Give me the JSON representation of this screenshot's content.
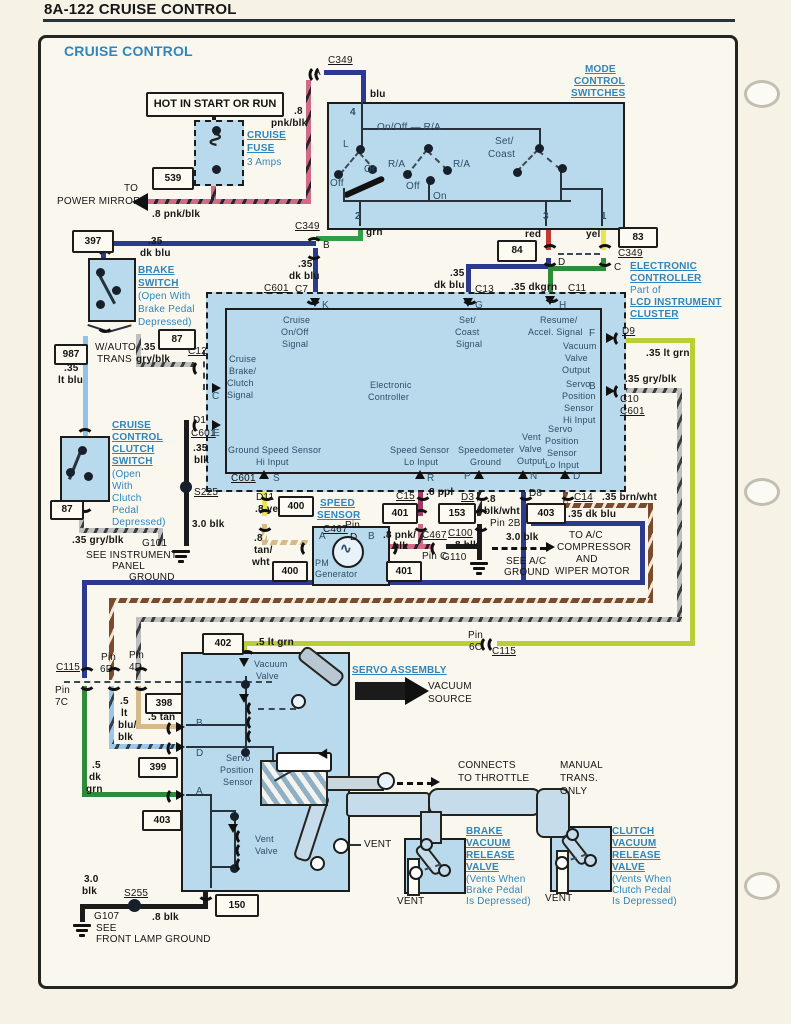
{
  "header": {
    "title": "8A-122 CRUISE CONTROL"
  },
  "diagram_title": "CRUISE CONTROL",
  "colors": {
    "component_fill": "#b9d9ec",
    "heading_blue": "#2f85bb",
    "wire_navy": "#2c3a8e",
    "wire_green": "#2f9e44",
    "wire_red": "#c23b32",
    "wire_yellow": "#e9e44f",
    "wire_lt_blue": "#8fc3e8",
    "wire_lt_green": "#bace38",
    "wire_dk_green": "#2e8b3a",
    "wire_purple": "#a03a62",
    "wire_tan": "#d8ba8a",
    "wire_pink": "#d06a85",
    "wire_black": "#1b1b1b"
  },
  "power": {
    "hot": "HOT IN START OR RUN",
    "fuse_l1": "CRUISE",
    "fuse_l2": "FUSE",
    "fuse_amps": "3 Amps",
    "ref": "539",
    "to": "TO",
    "dest": "POWER MIRRORS",
    "wire": ".8 pnk/blk",
    "wire_v1": ".8",
    "wire_v2": "pnk/blk"
  },
  "c349_top": {
    "label": "C349",
    "pin": "A",
    "wire": "blu"
  },
  "mode": {
    "l1": "MODE",
    "l2": "CONTROL",
    "l3": "SWITCHES",
    "pin4": "4",
    "pin2": "2",
    "pin3": "3",
    "pin1": "1",
    "onoff_ra": "On/Off — R/A",
    "l": "L",
    "off1": "Off",
    "on1": "On",
    "ra1": "R/A",
    "off2": "Off",
    "on2": "On",
    "ra2": "R/A",
    "set": "Set/",
    "coast": "Coast",
    "grn": "grn",
    "red": "red",
    "yel": "yel"
  },
  "conn": {
    "c349b": "C349",
    "pin_b": "B",
    "b_w1": ".35",
    "b_w2": "dk blu",
    "ref84": "84",
    "pin_d": "D",
    "ref83": "83",
    "c349c": "C349",
    "pin_c": "C",
    "g_w1": ".35",
    "g_w2": "dk blu",
    "c13": "C13",
    "h_w": ".35 dkgrn",
    "c11": "C11",
    "c601": "C601",
    "c7": "C7"
  },
  "ecu": {
    "t1": "ELECTRONIC",
    "t2": "CONTROLLER",
    "t3": "Part of",
    "t4": "LCD INSTRUMENT",
    "t5": "CLUSTER",
    "name1": "Electronic",
    "name2": "Controller",
    "pins": {
      "k": "K",
      "g": "G",
      "h": "H",
      "f": "F",
      "b": "B",
      "c": "C",
      "e": "E",
      "s": "S",
      "r": "R",
      "p": "P",
      "n": "N",
      "d": "D"
    },
    "sig_onoff": [
      "Cruise",
      "On/Off",
      "Signal"
    ],
    "sig_set": [
      "Set/",
      "Coast",
      "Signal"
    ],
    "sig_resume": [
      "Resume/",
      "Accel. Signal"
    ],
    "sig_vac": [
      "Vacuum",
      "Valve",
      "Output"
    ],
    "sig_servo_hi": [
      "Servo",
      "Position",
      "Sensor",
      "Hi Input"
    ],
    "sig_servo_lo": [
      "Servo",
      "Position",
      "Sensor",
      "Lo Input"
    ],
    "sig_vent": [
      "Vent",
      "Valve",
      "Output"
    ],
    "sig_brake": [
      "Cruise",
      "Brake/",
      "Clutch",
      "Signal"
    ],
    "sig_gss": [
      "Ground Speed Sensor",
      "Hi Input"
    ],
    "sig_ss": [
      "Speed Sensor",
      "Lo Input"
    ],
    "sig_spd": [
      "Speedometer",
      "Ground"
    ],
    "d9": "D9",
    "f_wire": ".35 lt grn",
    "b_wire": ".35 gry/blk",
    "c10": "C10",
    "c601b": "C601",
    "d1": "D1",
    "d1_c601": "C601",
    "e_w1": ".35",
    "e_w2": "blk",
    "s225": "S225",
    "blk30": "3.0 blk",
    "s_c601": "C601"
  },
  "brake_sw": {
    "ref397": "397",
    "w1": ".35",
    "w2": "dk blu",
    "name": [
      "BRAKE",
      "SWITCH",
      "(Open With",
      "Brake Pedal",
      "Depressed)"
    ],
    "ref987": "987",
    "lt1": ".35",
    "lt2": "lt blu",
    "auto1": "W/AUTO",
    "auto2": "TRANS",
    "gry1": ".35",
    "gry2": "gry/blk",
    "ref87": "87",
    "c12": "C12"
  },
  "clutch_sw": {
    "name": [
      "CRUISE",
      "CONTROL",
      "CLUTCH",
      "SWITCH",
      "(Open",
      "With",
      "Clutch",
      "Pedal",
      "Depressed)"
    ],
    "ref87": "87",
    "wire": ".35 gry/blk",
    "g101": "G101",
    "see": [
      "SEE INSTRUMENT",
      "PANEL",
      "GROUND"
    ]
  },
  "speed": {
    "t1": "SPEED",
    "t2": "SENSOR",
    "d11": "D11",
    "yel": ".8 yel",
    "ref400a": "400",
    "c467": "C467",
    "pin": "Pin",
    "pin_d": "D",
    "tw": [
      ".8",
      "tan/",
      "wht"
    ],
    "ref400b": "400",
    "pm1": "PM",
    "pm2": "Generator",
    "a": "A",
    "b": "B",
    "pb1": ".8 pnk/",
    "pb2": "blk",
    "c467b": "C467",
    "pin_c": "Pin C",
    "c15": "C15",
    "ppl": ".8 ppl",
    "ref401a": "401",
    "ref401b": "401"
  },
  "spd_gnd": {
    "d3": "D3",
    "w1": ".8",
    "w2": "blk/wht",
    "ref153": "153",
    "pin2b": "Pin 2B",
    "c100": "C100",
    "blk": ".8 blk",
    "g110": "G110",
    "blk30": "3.0 blk",
    "see1": "SEE A/C",
    "see2": "GROUND"
  },
  "vent_out": {
    "d8": "D8",
    "ref403": "403",
    "wire": ".35 dk blu",
    "dest": [
      "TO A/C",
      "COMPRESSOR",
      "AND",
      "WIPER MOTOR"
    ]
  },
  "servo_lo": {
    "c14": "C14",
    "wire": ".35 brn/wht"
  },
  "c115": {
    "left": "C115",
    "pin7c": [
      "Pin",
      "7C"
    ],
    "pin6d": [
      "Pin",
      "6D"
    ],
    "pin4d": [
      "Pin",
      "4D"
    ],
    "pin6c": [
      "Pin",
      "6C"
    ],
    "right": "C115"
  },
  "servo_wires": {
    "ref402": "402",
    "ltgrn": ".5 lt grn",
    "lb": [
      ".5",
      "lt",
      "blu/",
      "blk"
    ],
    "ref398": "398",
    "tan": ".5 tan",
    "ref399": "399",
    "dg": [
      ".5",
      "dk",
      "grn"
    ],
    "ref403": "403"
  },
  "servo": {
    "title": "SERVO ASSEMBLY",
    "vac_valve": [
      "Vacuum",
      "Valve"
    ],
    "pos_sensor": [
      "Servo",
      "Position",
      "Sensor"
    ],
    "vent_valve": [
      "Vent",
      "Valve"
    ],
    "a": "A",
    "b": "B",
    "d": "D",
    "vac_src": [
      "VACUUM",
      "SOURCE"
    ],
    "throttle": [
      "CONNECTS",
      "TO THROTTLE"
    ],
    "manual": [
      "MANUAL",
      "TRANS.",
      "ONLY"
    ],
    "vent_mid": "VENT",
    "ref150": "150"
  },
  "brake_valve": {
    "name": [
      "BRAKE",
      "VACUUM",
      "RELEASE",
      "VALVE",
      "(Vents When",
      "Brake Pedal",
      "Is Depressed)"
    ],
    "vent": "VENT"
  },
  "clutch_valve": {
    "name": [
      "CLUTCH",
      "VACUUM",
      "RELEASE",
      "VALVE",
      "(Vents When",
      "Clutch Pedal",
      "Is Depressed)"
    ],
    "vent": "VENT"
  },
  "bottom": {
    "blk30a": "3.0",
    "blk30b": "blk",
    "s255": "S255",
    "blk8": ".8 blk",
    "g107": "G107",
    "see": "SEE",
    "dest": "FRONT LAMP GROUND"
  }
}
